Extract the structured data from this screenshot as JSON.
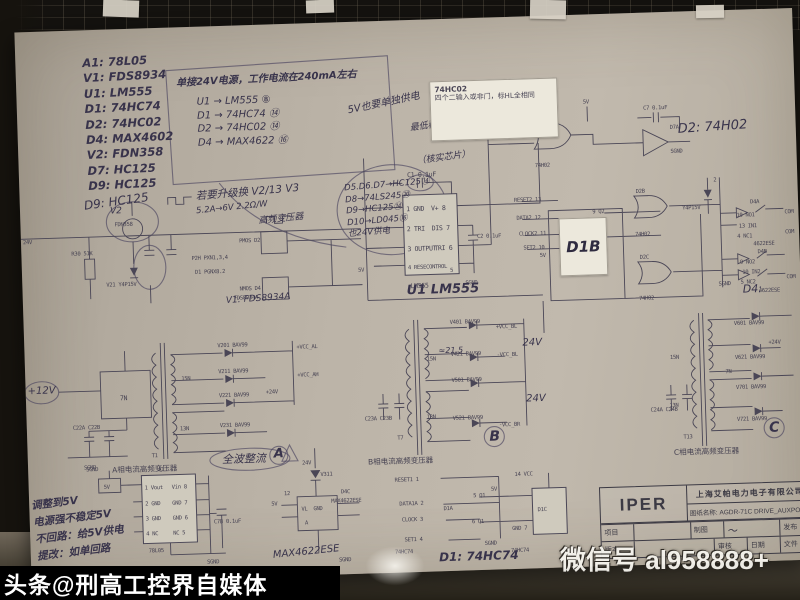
{
  "photo": {
    "colors": {
      "paper": "#bcb4a8",
      "ink": "#4a4656",
      "pencil": "#4a4360",
      "sticky": "#ece8dc",
      "band": "#000000"
    }
  },
  "component_list": [
    "A1: 78L05",
    "V1: FDS8934",
    "U1: LM555",
    "D1: 74HC74",
    "D2: 74HC02",
    "D4: MAX4602",
    "V2: FDN358",
    "D7: HC125",
    "D9: HC125"
  ],
  "notes": {
    "header": "单接24V电源，工作电流在240mA左右",
    "map1": [
      "U1 → LM555 ⑧",
      "D1 → 74HC74 ⑭",
      "D2 → 74HC02 ⑭",
      "D4 → MAX4622 ⑯"
    ],
    "brace": "5V也要单独供电",
    "map2": [
      "D5.D6.D7→HC125⑭",
      "D8→74LS245⑳",
      "D9→HC125⑭",
      "D10→LD045⑯",
      "也24V供电"
    ],
    "upgrade": "若要升级换 V2/13 V3",
    "reg": "最低稳到5V供电",
    "check": "（核实芯片）"
  },
  "sticky": {
    "l1": "74HC02",
    "l2": "四个二输入或非门，标HL全相同"
  },
  "power": {
    "v24": "24V",
    "v2": "V2",
    "v2t": "FDN358",
    "r30": "R30 51K",
    "v21": "V21 Y4P15V",
    "pmos": "PMOS D2",
    "p2h": "P2H PXN1,3,4",
    "d1p": "D1 PGNX8.2",
    "nmos": "NMOS D4",
    "fds": "FDS8934A",
    "hand_d9": "D9: HC125",
    "hand_v1": "V1: FDS8934A",
    "hand_cur": "5.2A→6V 2.2Ω/W",
    "hand_freq": "高频变压器"
  },
  "u1": {
    "hand": "U1 LM555",
    "chip": "LM555",
    "cap1": "C1 0.1uF",
    "cap2": "C2 0.1uF",
    "l1": "1 GND",
    "l2": "2 TRI",
    "l3": "3 OUTPUT",
    "l4": "4 RESECONTROL",
    "r1": "V+ 8",
    "r2": "DIS 7",
    "r3": "TRI 6",
    "r4": "5",
    "sgnd": "SGND",
    "v5": "5V"
  },
  "gates_top": {
    "d2d": "D2D",
    "chip": "74H02",
    "v5": "5V",
    "c7": "C7 0.1uF",
    "d7a": "D7A",
    "sgnd": "SGND",
    "hand": "D2: 74H02"
  },
  "gates_mid": {
    "d2b": "D2B",
    "chip1": "74H02",
    "d2c": "D2C",
    "chip2": "74H02"
  },
  "d1b": {
    "hand": "D1B",
    "chip": "74HC74",
    "l1": "RESET2 13",
    "l2": "DATA2 12",
    "l3": "CLOCK2 11",
    "l4": "SET2 10",
    "v5": "5V",
    "q": "9 Q2",
    "qb": "8 Q2"
  },
  "d4sw": {
    "zener": "Y4P15V",
    "pin2": "2",
    "a": "D4A",
    "a1": "10 NO1",
    "a2": "13 IN1",
    "a3": "4 NC1",
    "achip": "4622ESE",
    "b": "D4B",
    "b1": "9 NO2",
    "b2": "10 IN2",
    "b3": "5 NC2",
    "bchip": "4622ESE",
    "sgnd": "SGND",
    "com1": "COM",
    "com2": "COM",
    "com3": "COM",
    "hand": "D4:"
  },
  "xfmrA": {
    "t": "T1",
    "w7": "7N",
    "w15": "15N",
    "w13": "13N",
    "c22": "C22A  C22B",
    "sgnd": "SGND",
    "d1": "V201 BAV99",
    "d2": "V211 BAV99",
    "d3": "V221 BAV99",
    "d4": "V231 BAV99",
    "o1": "+VCC_AL",
    "o2": "+24V",
    "o3": "+VCC_AH",
    "label": "A相电流高频变压器",
    "hand_fw": "全波整流",
    "hand_mark": "A",
    "hand_12": "+12V"
  },
  "xfmrB": {
    "t": "T7",
    "w15": "15N",
    "w13": "13N",
    "hand_ratio": "≈21.5",
    "c23": "C23A  C23B",
    "d1": "V401 BAV99",
    "d2": "V421 BAV99",
    "d3": "V501 BAV99",
    "d4": "V521 BAV99",
    "o1": "+VCC_BL",
    "o3": "-VCC_BL",
    "o4": "-VCC_BR",
    "hand24": "24V",
    "label": "B相电流高频变压器",
    "hand_mark": "B"
  },
  "xfmrC": {
    "t": "T13",
    "w15": "15N",
    "w13": "13N",
    "w7": "7N",
    "c24": "C24A  C24B",
    "d1": "V601 BAV99",
    "d2": "V621 BAV99",
    "d3": "V701 BAV99",
    "d4": "V721 BAV99",
    "o1": "+24V",
    "label": "C相电流高频变压器",
    "hand_mark": "C"
  },
  "a1": {
    "name": "A1",
    "chip": "78L05",
    "v5": "5V",
    "sgnd_top": "SGND",
    "sgnd_bot": "SGND",
    "cap": "C7B 0.1uF",
    "l1": "1 Vout",
    "l2": "2 GND",
    "l3": "3 GND",
    "l4": "4 NC",
    "r1": "Vin 8",
    "r2": "GND 7",
    "r3": "GND 6",
    "r4": "NC 5",
    "hand_note": [
      "调整到5V",
      "电源强不稳定5V",
      "不回路：给5V供电",
      "提改：如单回路"
    ]
  },
  "d4c": {
    "v24": "24V",
    "v311": "V311",
    "v5": "5V",
    "p12": "12",
    "vl": "VL",
    "gnd": "GND",
    "a": "A",
    "name": "D4C",
    "chip": "MAX4622ESE",
    "sgnd": "SGND",
    "hand": "MAX4622ESE"
  },
  "d1a": {
    "l1": "RESET1 1",
    "l2": "DATA1A 2",
    "l3": "CLOCK 3",
    "l4": "SET1 4",
    "chip": "74HC74",
    "name": "D1A",
    "q": "5 Q1",
    "qb": "6 Q1",
    "v5": "5V",
    "p14": "14 VCC",
    "d1c": "D1C",
    "gnd": "GND 7",
    "sgnd": "SGND",
    "chip2": "74HC74",
    "hand": "D1: 74HC74"
  },
  "title_block": {
    "logo": "IPER",
    "company": "上海艾帕电力电子有限公司",
    "doc_label": "图纸名称:",
    "doc_name": "AGDR-71C DRIVE_AUXPO",
    "r1c1": "项目",
    "r1c2": "制图",
    "r1c3": "发布",
    "signature": "〜",
    "r2c1": "版本",
    "r2c2": "审核",
    "r2c3": "日期",
    "r2c4": "文件"
  },
  "watermarks": {
    "band": "头条@刑高工控界自媒体",
    "ghost1": "微信号",
    "ghost2": "al958888+"
  }
}
